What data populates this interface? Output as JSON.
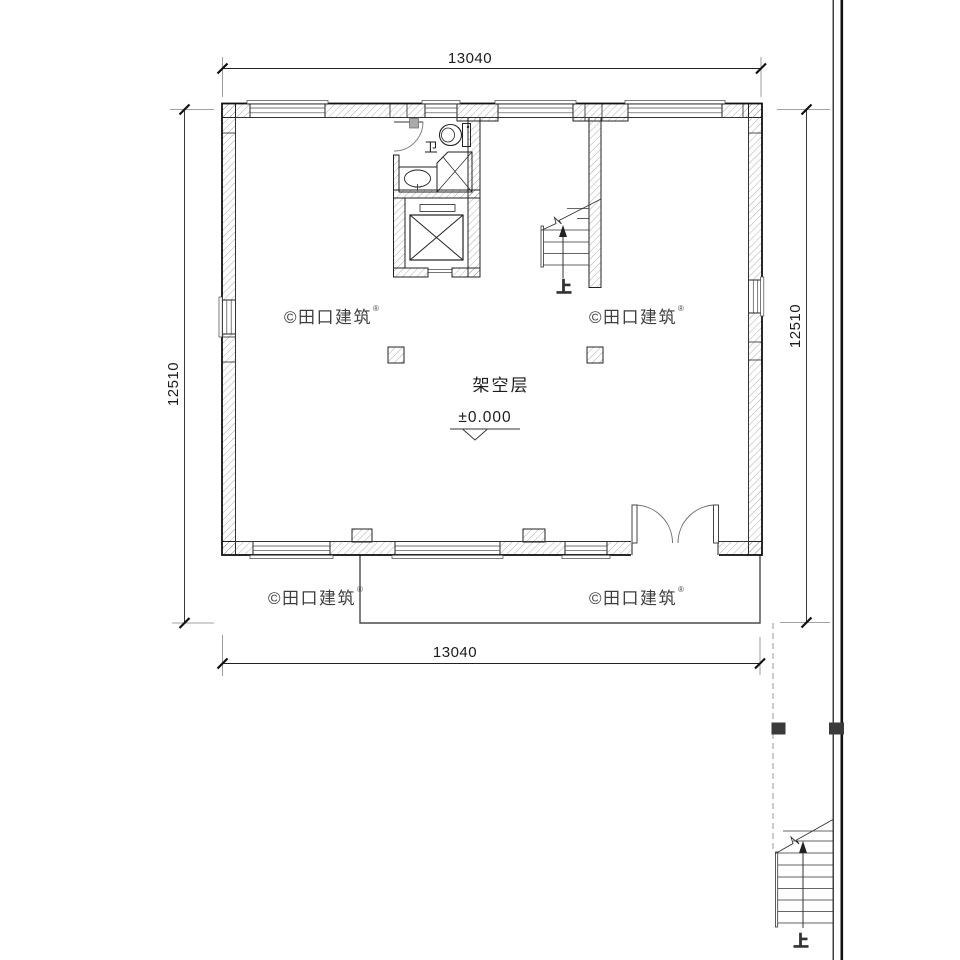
{
  "labels": {
    "floor": "架空层",
    "elevation": "±0.000",
    "bathroom": "卫",
    "stairs_up_main": "上",
    "stairs_up_exterior": "上"
  },
  "dimensions": {
    "top": "13040",
    "bottom": "13040",
    "left": "12510",
    "right": "12510"
  },
  "watermark": {
    "text": "©田口建筑",
    "registered": "®"
  },
  "colors": {
    "line": "#1c1c1c",
    "hatch": "#555555",
    "extension_line": "#858585",
    "dashed_line": "#9a9a9a",
    "watermark": "#d2d2d2",
    "marker_square": "#3a3a3a",
    "background": "#ffffff"
  }
}
